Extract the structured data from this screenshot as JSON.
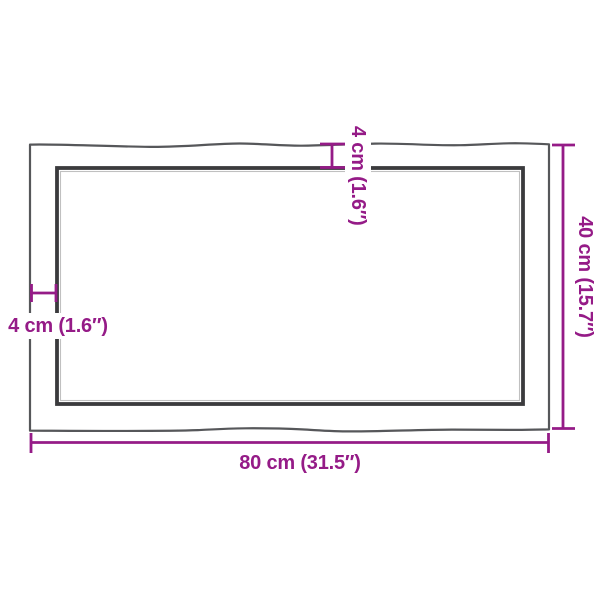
{
  "product_diagram": {
    "width_label": "80 cm (31.5″)",
    "height_label": "40 cm (15.7″)",
    "thickness_top_label": "4 cm (1.6″)",
    "thickness_left_label": "4 cm (1.6″)"
  },
  "colors": {
    "accent": "#951B87",
    "outer": "#56575A",
    "inner": "#3B3B3D",
    "bg": "#FFFFFF"
  }
}
